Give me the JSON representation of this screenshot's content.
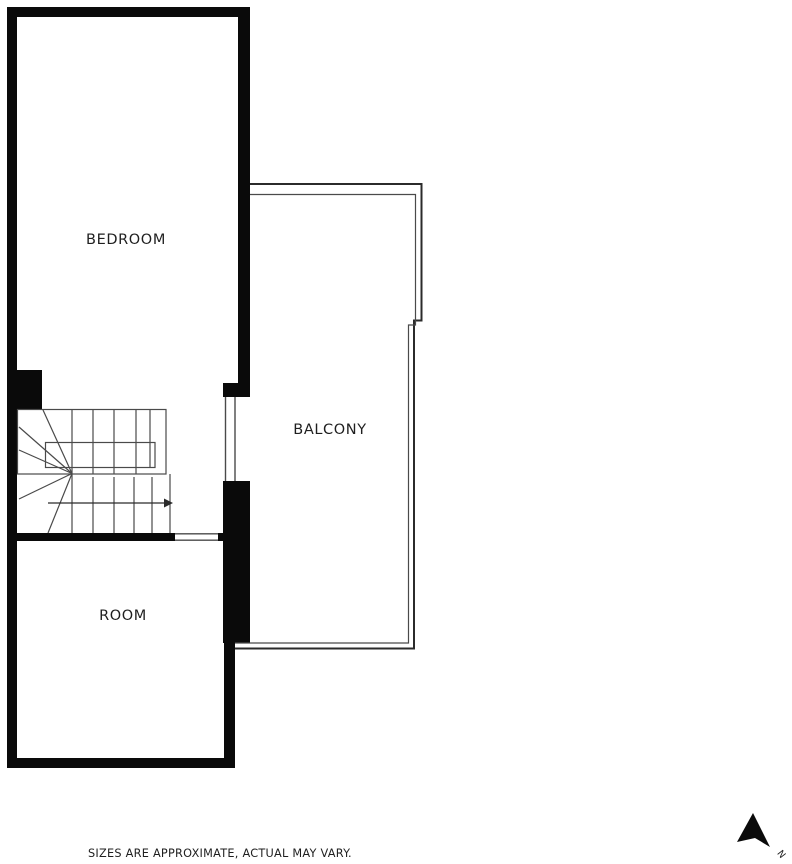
{
  "colors": {
    "wall": "#0a0a0a",
    "outline": "#2b2b2b",
    "line": "#4a4a4a",
    "text": "#1f1f1f",
    "background": "#ffffff"
  },
  "rooms": [
    {
      "label": "BEDROOM"
    },
    {
      "label": "BALCONY"
    },
    {
      "label": "ROOM"
    }
  ],
  "footer": {
    "disclaimer": "SIZES ARE APPROXIMATE, ACTUAL MAY VARY."
  },
  "compass": {
    "label": "N"
  }
}
